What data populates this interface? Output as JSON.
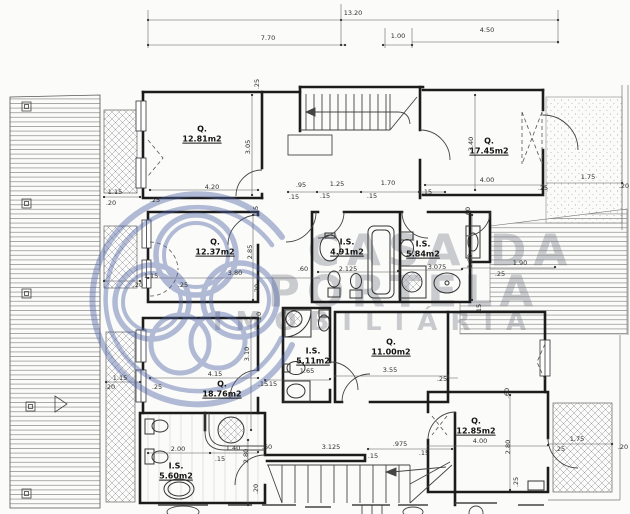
{
  "watermark": {
    "line1": "CASA DA",
    "line2": "PORTELA",
    "line3": "IMOBILIÁRIA"
  },
  "rooms": [
    {
      "name": "Q.",
      "area": "12.81m2"
    },
    {
      "name": "Q.",
      "area": "17.45m2"
    },
    {
      "name": "Q.",
      "area": "12.37m2"
    },
    {
      "name": "I.S.",
      "area": "4.91m2"
    },
    {
      "name": "I.S.",
      "area": "5.84m2"
    },
    {
      "name": "I.S.",
      "area": "5.11m2"
    },
    {
      "name": "Q.",
      "area": "11.00m2"
    },
    {
      "name": "Q.",
      "area": "18.76m2"
    },
    {
      "name": "I.S.",
      "area": "5.60m2"
    },
    {
      "name": "Q.",
      "area": "12.85m2"
    }
  ],
  "dims": [
    "13.20",
    "7.70",
    "1.00",
    "4.50",
    "4.20",
    ".95",
    ".15",
    "1.25",
    ".15",
    "1.70",
    ".15",
    ".15",
    "4.00",
    "1.75",
    ".25",
    ".20",
    "1.15",
    ".20",
    ".25",
    "3.80",
    "1.15",
    ".20",
    ".25",
    ".60",
    "2.125",
    "3.075",
    "1.90",
    ".25",
    "4.15",
    ".25",
    ".15",
    "1.65",
    "3.55",
    ".25",
    "1.15",
    ".20",
    "2.00",
    "1.40",
    ".60",
    ".15",
    "3.125",
    ".15",
    ".975",
    ".15",
    "4.00",
    ".25",
    "1.75",
    ".20",
    ".15",
    "3.05",
    "3.40",
    "2.85",
    "1.90",
    "3.10",
    ".60",
    "2.80",
    ".25",
    ".20",
    ".25",
    ".15",
    ".20",
    ".60",
    "2.80",
    ".20",
    ".15"
  ]
}
